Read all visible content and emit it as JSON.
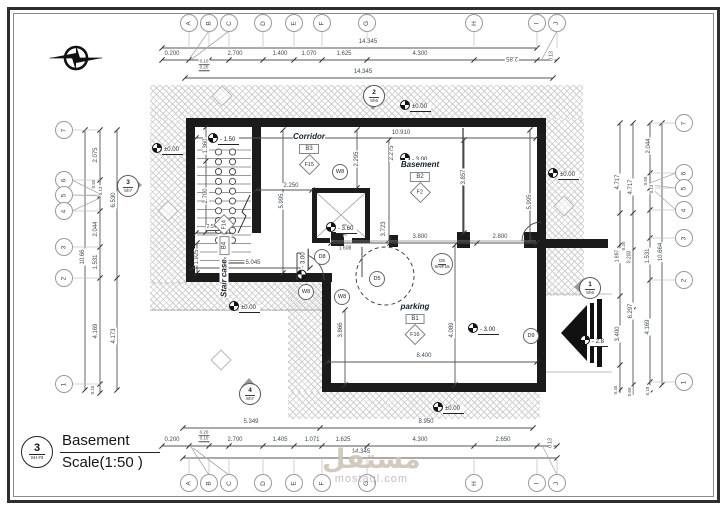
{
  "title_block": {
    "number": "3",
    "sheet": "SH #3",
    "title": "Basement",
    "scale": "Scale(1:50 )"
  },
  "watermark": {
    "arabic": "مستقل",
    "latin": "mostaql.com"
  },
  "grid_letters": [
    "A",
    "B",
    "C",
    "D",
    "E",
    "F",
    "G",
    "H",
    "I",
    "J"
  ],
  "grid_numbers": [
    "7",
    "6",
    "5",
    "4",
    "3",
    "2",
    "1"
  ],
  "rooms": [
    {
      "name": "Corridor",
      "tag": "B3",
      "ftag": "F15",
      "x": 309,
      "y": 138
    },
    {
      "name": "Basement",
      "tag": "B2",
      "ftag": "F2",
      "x": 420,
      "y": 166
    },
    {
      "name": "parking",
      "tag": "B1",
      "ftag": "F16",
      "x": 415,
      "y": 308
    },
    {
      "name": "Stair case",
      "tag": "B4",
      "ftag": "F14",
      "x": 224,
      "y": 257,
      "vert": true
    }
  ],
  "door_tags": [
    {
      "t": "D8",
      "x": 322,
      "y": 257
    },
    {
      "t": "D5",
      "x": 377,
      "y": 279
    },
    {
      "t": "D9",
      "x": 531,
      "y": 336
    },
    {
      "t": "W8",
      "x": 340,
      "y": 172
    },
    {
      "t": "W8",
      "x": 306,
      "y": 292
    },
    {
      "t": "W8",
      "x": 342,
      "y": 297
    }
  ],
  "shaft_tag": {
    "top": "D5",
    "bottom": "SH/F15",
    "x": 442,
    "y": 264
  },
  "levels": [
    {
      "t": "±0.00",
      "x": 156,
      "y": 147
    },
    {
      "t": "±0.00",
      "x": 404,
      "y": 104
    },
    {
      "t": "±0.00",
      "x": 552,
      "y": 172
    },
    {
      "t": "±0.00",
      "x": 233,
      "y": 305
    },
    {
      "t": "±0.00",
      "x": 437,
      "y": 406
    },
    {
      "t": "- 1.50",
      "x": 212,
      "y": 137
    },
    {
      "t": "- 3.00",
      "x": 404,
      "y": 157
    },
    {
      "t": "- 3.00",
      "x": 472,
      "y": 327
    },
    {
      "t": "- 2.8",
      "x": 584,
      "y": 339
    },
    {
      "t": "- 3.00",
      "x": 290,
      "y": 263,
      "r": 90
    },
    {
      "t": "- 3.60",
      "x": 330,
      "y": 226
    }
  ],
  "section_markers": [
    {
      "num": "2",
      "sheet": "Sh6",
      "x": 374,
      "y": 96,
      "dir": "down"
    },
    {
      "num": "1",
      "sheet": "Sh6",
      "x": 590,
      "y": 288,
      "dir": "left"
    },
    {
      "num": "3",
      "sheet": "Sh7",
      "x": 128,
      "y": 186,
      "dir": "right"
    },
    {
      "num": "4",
      "sheet": "Sh7",
      "x": 250,
      "y": 394,
      "dir": "up"
    }
  ],
  "dim_labels": [
    {
      "t": "14.345",
      "x": 368,
      "y": 42
    },
    {
      "t": "0.200",
      "x": 172,
      "y": 54
    },
    {
      "t": "0.10",
      "x": 204,
      "y": 62,
      "s": 4.5,
      "u": 1
    },
    {
      "t": "0.20",
      "x": 204,
      "y": 68,
      "s": 4.5,
      "u": 1
    },
    {
      "t": "2.700",
      "x": 235,
      "y": 54
    },
    {
      "t": "1.400",
      "x": 280,
      "y": 54
    },
    {
      "t": "1.070",
      "x": 309,
      "y": 54
    },
    {
      "t": "1.625",
      "x": 344,
      "y": 54
    },
    {
      "t": "4.300",
      "x": 420,
      "y": 54
    },
    {
      "t": "2.85",
      "x": 512,
      "y": 58,
      "r": 180
    },
    {
      "t": "0.13",
      "x": 552,
      "y": 56,
      "r": 90,
      "s": 5
    },
    {
      "t": "14.345",
      "x": 363,
      "y": 72
    },
    {
      "t": "5.349",
      "x": 251,
      "y": 422
    },
    {
      "t": "8.950",
      "x": 426,
      "y": 422
    },
    {
      "t": "0.200",
      "x": 172,
      "y": 440
    },
    {
      "t": "0.20",
      "x": 204,
      "y": 433,
      "s": 4.5,
      "u": 1
    },
    {
      "t": "0.10",
      "x": 204,
      "y": 439,
      "s": 4.5,
      "u": 1
    },
    {
      "t": "2.700",
      "x": 235,
      "y": 440
    },
    {
      "t": "1.405",
      "x": 280,
      "y": 440
    },
    {
      "t": "1.071",
      "x": 312,
      "y": 440
    },
    {
      "t": "1.625",
      "x": 343,
      "y": 440
    },
    {
      "t": "4.300",
      "x": 420,
      "y": 440
    },
    {
      "t": "2.650",
      "x": 503,
      "y": 440
    },
    {
      "t": "0.13",
      "x": 551,
      "y": 443,
      "r": 90,
      "s": 5
    },
    {
      "t": "14.345",
      "x": 361,
      "y": 452
    },
    {
      "t": "2.075",
      "x": 96,
      "y": 155,
      "r": 90
    },
    {
      "t": "0.50",
      "x": 94,
      "y": 184,
      "r": 90,
      "s": 4.5
    },
    {
      "t": "0.13",
      "x": 101,
      "y": 191,
      "r": 90,
      "s": 4.5
    },
    {
      "t": "2.044",
      "x": 96,
      "y": 229,
      "r": 90
    },
    {
      "t": "1.531",
      "x": 96,
      "y": 262,
      "r": 90
    },
    {
      "t": "10.66",
      "x": 83,
      "y": 257,
      "r": 90
    },
    {
      "t": "4.169",
      "x": 96,
      "y": 331,
      "r": 90
    },
    {
      "t": "0.16",
      "x": 93,
      "y": 390,
      "r": 90,
      "s": 4.5
    },
    {
      "t": "6.530",
      "x": 114,
      "y": 200,
      "r": 90
    },
    {
      "t": "4.173",
      "x": 114,
      "y": 336,
      "r": 90
    },
    {
      "t": "2.044",
      "x": 649,
      "y": 146,
      "r": 90
    },
    {
      "t": "4.717",
      "x": 618,
      "y": 182,
      "r": 90
    },
    {
      "t": "4.717",
      "x": 631,
      "y": 187,
      "r": 90
    },
    {
      "t": "0.50",
      "x": 646,
      "y": 181,
      "r": 90,
      "s": 4.5
    },
    {
      "t": "0.13",
      "x": 652,
      "y": 189,
      "r": 90,
      "s": 4.5
    },
    {
      "t": "0.20",
      "x": 624,
      "y": 246,
      "r": 90,
      "s": 4.5
    },
    {
      "t": "1.897",
      "x": 618,
      "y": 256,
      "r": 90,
      "s": 5
    },
    {
      "t": "0.200",
      "x": 630,
      "y": 257,
      "r": 90,
      "s": 5
    },
    {
      "t": "1.531",
      "x": 648,
      "y": 256,
      "r": 90
    },
    {
      "t": "10.664",
      "x": 661,
      "y": 252,
      "r": 90
    },
    {
      "t": "6.297",
      "x": 631,
      "y": 311,
      "r": 90
    },
    {
      "t": "3.400",
      "x": 618,
      "y": 334,
      "r": 90
    },
    {
      "t": "4.169",
      "x": 648,
      "y": 327,
      "r": 90
    },
    {
      "t": "0.45",
      "x": 616,
      "y": 390,
      "r": 90,
      "s": 4.5
    },
    {
      "t": "0.60",
      "x": 630,
      "y": 392,
      "r": 90,
      "s": 4.5
    },
    {
      "t": "0.18",
      "x": 648,
      "y": 391,
      "r": 90,
      "s": 4.5
    },
    {
      "t": "10.910",
      "x": 401,
      "y": 133
    },
    {
      "t": "1.360",
      "x": 206,
      "y": 146,
      "r": 90
    },
    {
      "t": "2.700",
      "x": 206,
      "y": 196,
      "r": 90
    },
    {
      "t": "2.548",
      "x": 213,
      "y": 228,
      "s": 5,
      "u": 1
    },
    {
      "t": "1.925",
      "x": 197,
      "y": 257,
      "r": 90
    },
    {
      "t": "5.045",
      "x": 253,
      "y": 263
    },
    {
      "t": "2.250",
      "x": 291,
      "y": 186
    },
    {
      "t": "5.995",
      "x": 282,
      "y": 201,
      "r": 90
    },
    {
      "t": "2.295",
      "x": 357,
      "y": 159,
      "r": 90
    },
    {
      "t": "2.275",
      "x": 392,
      "y": 153,
      "r": 90
    },
    {
      "t": "3.857",
      "x": 464,
      "y": 177,
      "r": 90
    },
    {
      "t": "5.995",
      "x": 530,
      "y": 202,
      "r": 90
    },
    {
      "t": "3.723",
      "x": 384,
      "y": 229,
      "r": 90
    },
    {
      "t": "3.400",
      "x": 346,
      "y": 230,
      "r": 90,
      "s": 5
    },
    {
      "t": "1.608",
      "x": 345,
      "y": 249,
      "s": 5
    },
    {
      "t": "3.800",
      "x": 420,
      "y": 237
    },
    {
      "t": "2.800",
      "x": 500,
      "y": 237
    },
    {
      "t": "3.866",
      "x": 341,
      "y": 330,
      "r": 90
    },
    {
      "t": "4.089",
      "x": 452,
      "y": 330,
      "r": 90
    },
    {
      "t": "8.400",
      "x": 424,
      "y": 356
    }
  ]
}
